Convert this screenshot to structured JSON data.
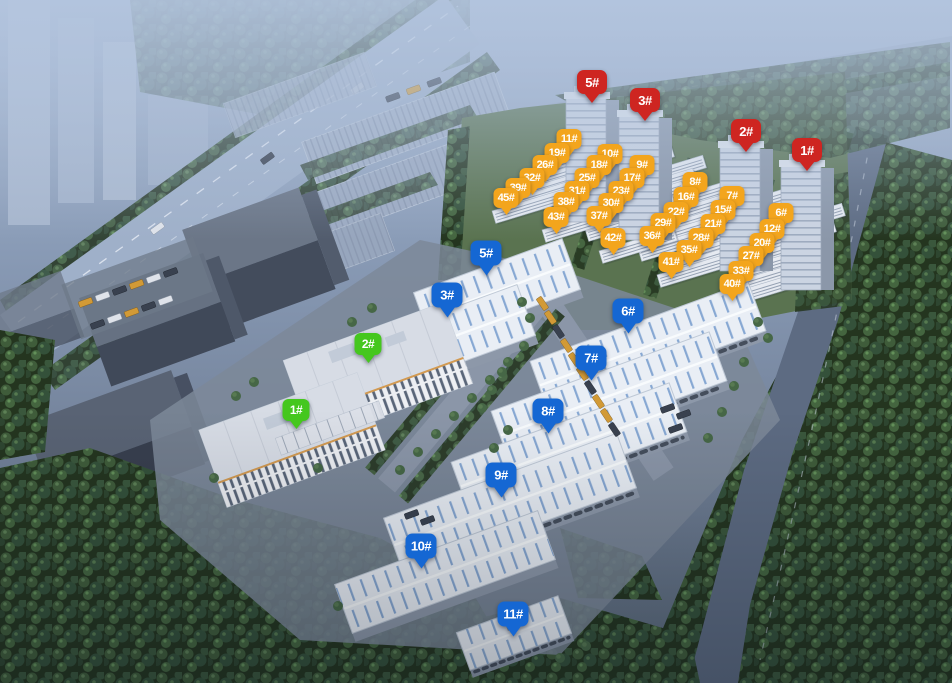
{
  "scene": {
    "type": "aerial-site-rendering",
    "marker_suffix": "#",
    "colors": {
      "highrise_red": "#ce2521",
      "townhouse_orange": "#f3a51d",
      "warehouse_blue": "#1567d3",
      "plant_green": "#45c71e"
    }
  },
  "markers": [
    {
      "name": "highrise",
      "cls": "p-red",
      "color": "#ce2521",
      "items": [
        {
          "label": "5#",
          "x": 592,
          "y": 82
        },
        {
          "label": "3#",
          "x": 645,
          "y": 100
        },
        {
          "label": "2#",
          "x": 746,
          "y": 131
        },
        {
          "label": "1#",
          "x": 807,
          "y": 150
        }
      ]
    },
    {
      "name": "townhouse",
      "cls": "p-orange",
      "color": "#f3a51d",
      "items": [
        {
          "label": "11#",
          "x": 569,
          "y": 139
        },
        {
          "label": "10#",
          "x": 610,
          "y": 154
        },
        {
          "label": "9#",
          "x": 642,
          "y": 165
        },
        {
          "label": "8#",
          "x": 695,
          "y": 182
        },
        {
          "label": "7#",
          "x": 732,
          "y": 196
        },
        {
          "label": "6#",
          "x": 781,
          "y": 213
        },
        {
          "label": "19#",
          "x": 557,
          "y": 153
        },
        {
          "label": "18#",
          "x": 599,
          "y": 165
        },
        {
          "label": "17#",
          "x": 632,
          "y": 178
        },
        {
          "label": "16#",
          "x": 686,
          "y": 197
        },
        {
          "label": "15#",
          "x": 723,
          "y": 210
        },
        {
          "label": "12#",
          "x": 772,
          "y": 229
        },
        {
          "label": "26#",
          "x": 545,
          "y": 165
        },
        {
          "label": "25#",
          "x": 587,
          "y": 178
        },
        {
          "label": "23#",
          "x": 621,
          "y": 191
        },
        {
          "label": "22#",
          "x": 676,
          "y": 212
        },
        {
          "label": "21#",
          "x": 713,
          "y": 224
        },
        {
          "label": "20#",
          "x": 762,
          "y": 243
        },
        {
          "label": "32#",
          "x": 532,
          "y": 178
        },
        {
          "label": "31#",
          "x": 577,
          "y": 191
        },
        {
          "label": "30#",
          "x": 611,
          "y": 203
        },
        {
          "label": "29#",
          "x": 663,
          "y": 223
        },
        {
          "label": "28#",
          "x": 701,
          "y": 238
        },
        {
          "label": "27#",
          "x": 751,
          "y": 256
        },
        {
          "label": "39#",
          "x": 518,
          "y": 188
        },
        {
          "label": "38#",
          "x": 566,
          "y": 202
        },
        {
          "label": "37#",
          "x": 599,
          "y": 216
        },
        {
          "label": "36#",
          "x": 652,
          "y": 236
        },
        {
          "label": "35#",
          "x": 689,
          "y": 250
        },
        {
          "label": "33#",
          "x": 741,
          "y": 271
        },
        {
          "label": "45#",
          "x": 506,
          "y": 198
        },
        {
          "label": "43#",
          "x": 556,
          "y": 217
        },
        {
          "label": "42#",
          "x": 613,
          "y": 238
        },
        {
          "label": "41#",
          "x": 671,
          "y": 262
        },
        {
          "label": "40#",
          "x": 732,
          "y": 284
        }
      ]
    },
    {
      "name": "warehouse",
      "cls": "p-blue",
      "color": "#1567d3",
      "items": [
        {
          "label": "5#",
          "x": 486,
          "y": 253
        },
        {
          "label": "3#",
          "x": 447,
          "y": 295
        },
        {
          "label": "6#",
          "x": 628,
          "y": 311
        },
        {
          "label": "7#",
          "x": 591,
          "y": 358
        },
        {
          "label": "8#",
          "x": 548,
          "y": 411
        },
        {
          "label": "9#",
          "x": 501,
          "y": 475
        },
        {
          "label": "10#",
          "x": 421,
          "y": 546
        },
        {
          "label": "11#",
          "x": 513,
          "y": 614
        }
      ]
    },
    {
      "name": "plant",
      "cls": "p-green",
      "color": "#45c71e",
      "items": [
        {
          "label": "2#",
          "x": 368,
          "y": 344
        },
        {
          "label": "1#",
          "x": 296,
          "y": 410
        }
      ]
    }
  ]
}
